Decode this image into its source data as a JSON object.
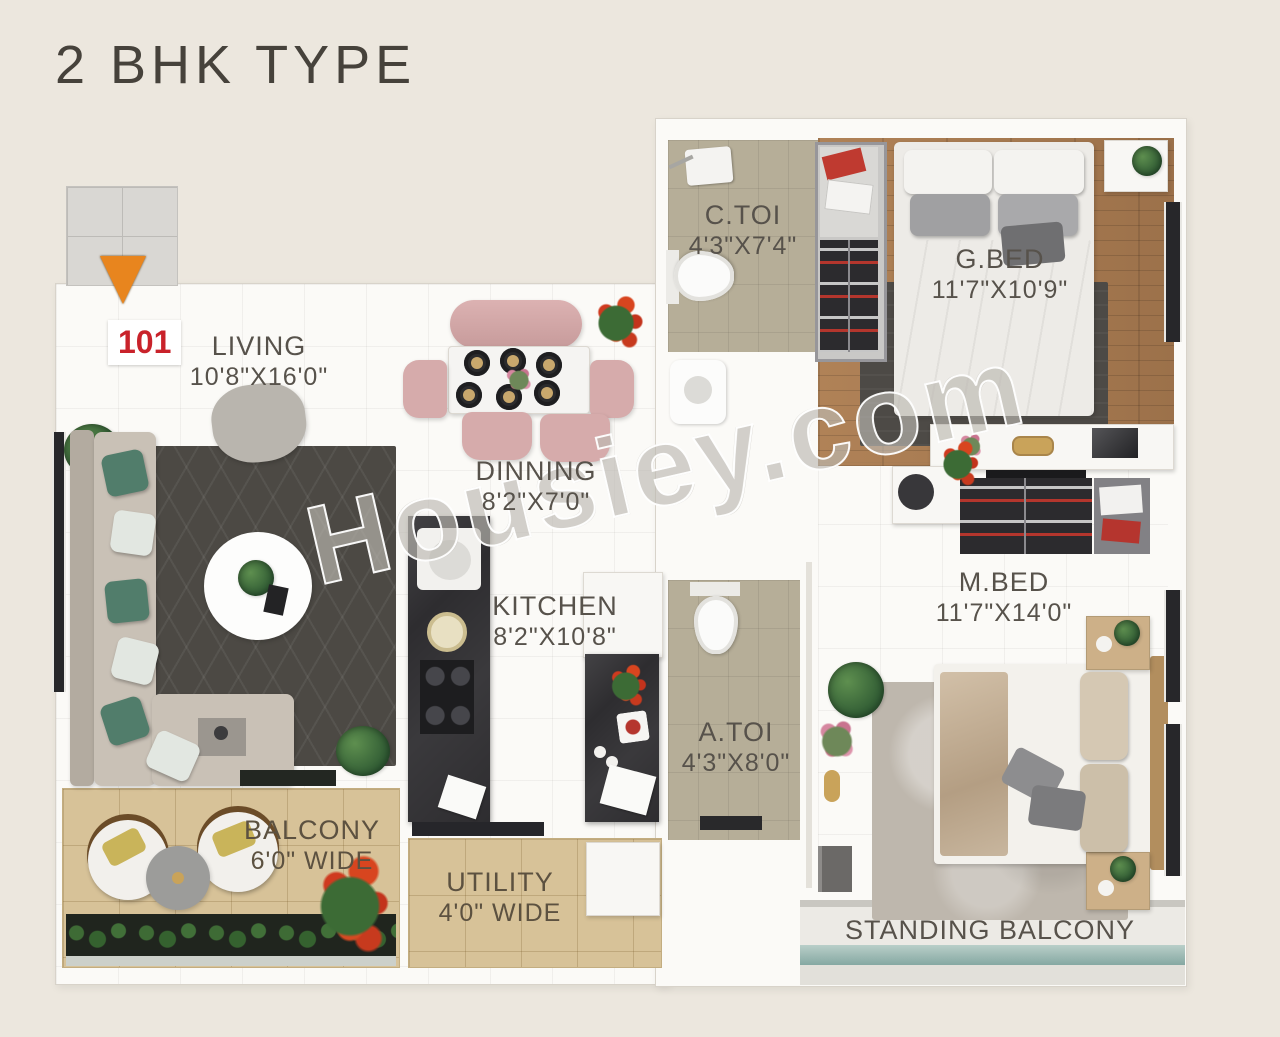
{
  "title": "2 BHK TYPE",
  "unit": {
    "number": "101"
  },
  "watermark": "Housiey.com",
  "rooms": {
    "living": {
      "name": "LIVING",
      "dim": "10'8\"X16'0\""
    },
    "dinning": {
      "name": "DINNING",
      "dim": "8'2\"X7'0\""
    },
    "kitchen": {
      "name": "KITCHEN",
      "dim": "8'2\"X10'8\""
    },
    "ctoi": {
      "name": "C.TOI",
      "dim": "4'3\"X7'4\""
    },
    "gbed": {
      "name": "G.BED",
      "dim": "11'7\"X10'9\""
    },
    "mbed": {
      "name": "M.BED",
      "dim": "11'7\"X14'0\""
    },
    "atoi": {
      "name": "A.TOI",
      "dim": "4'3\"X8'0\""
    },
    "balcony": {
      "name": "BALCONY",
      "dim": "6'0\" WIDE"
    },
    "utility": {
      "name": "UTILITY",
      "dim": "4'0\" WIDE"
    },
    "standing_balcony": {
      "name": "STANDING BALCONY"
    }
  },
  "colors": {
    "background": "#ece7de",
    "entry_arrow": "#e8851e",
    "unit_number": "#c9222a",
    "wood_floor": "#a87c54",
    "balcony_tile": "#d7c298",
    "toilet_tile": "#b6ae98",
    "kitchen_counter": "#2e2d30",
    "water_band": "#8fb3ad",
    "label_text": "#57524b"
  }
}
